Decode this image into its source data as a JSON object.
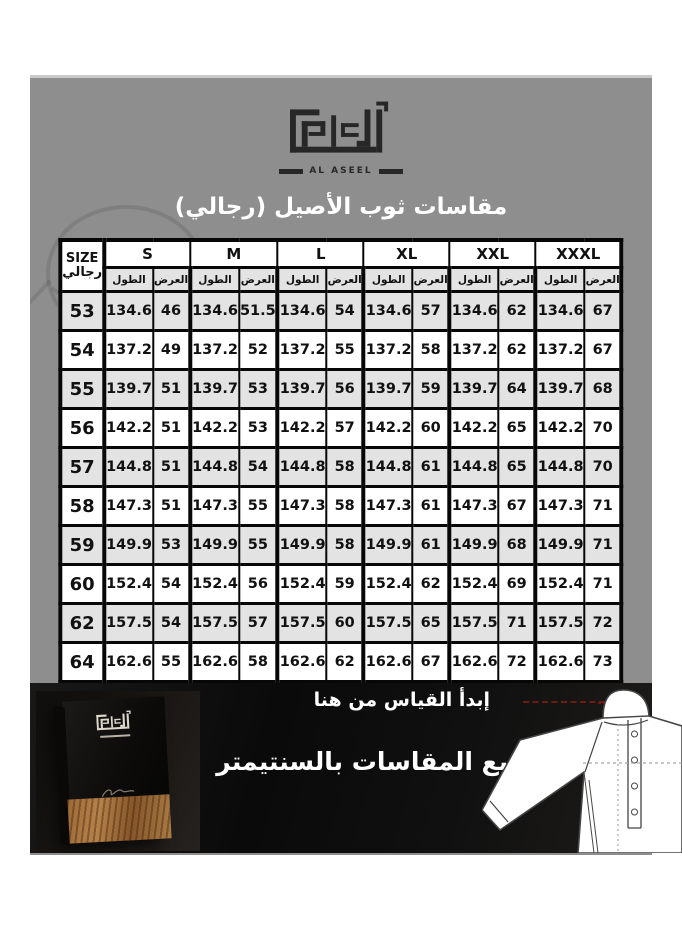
{
  "brand": {
    "arabic_name": "الأصيل",
    "latin_name": "AL ASEEL"
  },
  "title": "مقاسات ثوب الأصيل (رجالي)",
  "table": {
    "size_header_top": "SIZE",
    "size_header_bottom": "رجالي",
    "groups": [
      "S",
      "M",
      "L",
      "XL",
      "XXL",
      "XXXL"
    ],
    "col_length": "الطول",
    "col_width": "العرض",
    "rows": [
      {
        "size": "53",
        "cells": [
          "134.6",
          "46",
          "134.6",
          "51.5",
          "134.6",
          "54",
          "134.6",
          "57",
          "134.6",
          "62",
          "134.6",
          "67"
        ]
      },
      {
        "size": "54",
        "cells": [
          "137.2",
          "49",
          "137.2",
          "52",
          "137.2",
          "55",
          "137.2",
          "58",
          "137.2",
          "62",
          "137.2",
          "67"
        ]
      },
      {
        "size": "55",
        "cells": [
          "139.7",
          "51",
          "139.7",
          "53",
          "139.7",
          "56",
          "139.7",
          "59",
          "139.7",
          "64",
          "139.7",
          "68"
        ]
      },
      {
        "size": "56",
        "cells": [
          "142.2",
          "51",
          "142.2",
          "53",
          "142.2",
          "57",
          "142.2",
          "60",
          "142.2",
          "65",
          "142.2",
          "70"
        ]
      },
      {
        "size": "57",
        "cells": [
          "144.8",
          "51",
          "144.8",
          "54",
          "144.8",
          "58",
          "144.8",
          "61",
          "144.8",
          "65",
          "144.8",
          "70"
        ]
      },
      {
        "size": "58",
        "cells": [
          "147.3",
          "51",
          "147.3",
          "55",
          "147.3",
          "58",
          "147.3",
          "61",
          "147.3",
          "67",
          "147.3",
          "71"
        ]
      },
      {
        "size": "59",
        "cells": [
          "149.9",
          "53",
          "149.9",
          "55",
          "149.9",
          "58",
          "149.9",
          "61",
          "149.9",
          "68",
          "149.9",
          "71"
        ]
      },
      {
        "size": "60",
        "cells": [
          "152.4",
          "54",
          "152.4",
          "56",
          "152.4",
          "59",
          "152.4",
          "62",
          "152.4",
          "69",
          "152.4",
          "71"
        ]
      },
      {
        "size": "62",
        "cells": [
          "157.5",
          "54",
          "157.5",
          "57",
          "157.5",
          "60",
          "157.5",
          "65",
          "157.5",
          "71",
          "157.5",
          "72"
        ]
      },
      {
        "size": "64",
        "cells": [
          "162.6",
          "55",
          "162.6",
          "58",
          "162.6",
          "62",
          "162.6",
          "67",
          "162.6",
          "72",
          "162.6",
          "73"
        ]
      }
    ]
  },
  "footer": {
    "start_text": "إبدأ القياس من هنا",
    "units_note": "جميع المقاسات بالسنتيمتر"
  },
  "colors": {
    "panel_gray": "#8e8e8e",
    "table_shade": "#e3e3e3",
    "banner_black": "#0f0f0f",
    "measure_red": "#6e1b12",
    "wood_brown": "#9c6a38"
  }
}
